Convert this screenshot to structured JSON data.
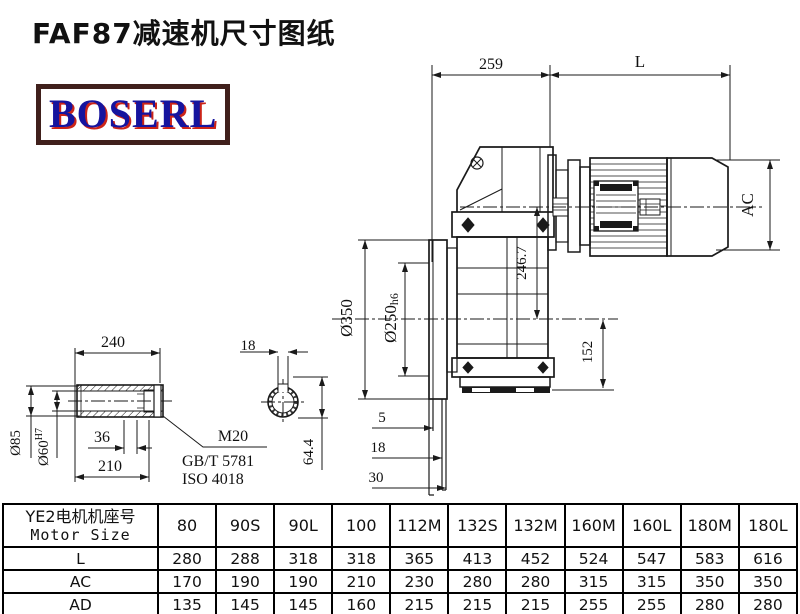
{
  "header": {
    "title": "FAF87减速机尺寸图纸",
    "logo_text": "BOSERL"
  },
  "colors": {
    "line": "#1a1a1a",
    "logo_border": "#40201c",
    "logo_text": "#16149e",
    "logo_shadow": "#cc2418",
    "table_border": "#000000"
  },
  "drawing": {
    "top_dims": {
      "housing_length": "259",
      "motor_length": "L"
    },
    "main_dims": {
      "motor_diameter": "AC",
      "center_distance": "246.7",
      "base_height": "152",
      "flange_od": "Ø350",
      "spigot": "Ø250",
      "spigot_fit": "h6",
      "flange_step1": "5",
      "flange_step2": "18",
      "flange_step3": "30"
    },
    "shaft_dims": {
      "hub_length": "240",
      "bolt_depth": "36",
      "shaft_length": "210",
      "hub_od": "Ø85",
      "bore": "Ø60",
      "bore_fit": "H7",
      "bolt": "M20",
      "bolt_std1": "GB/T 5781",
      "bolt_std2": "ISO 4018"
    },
    "section_dims": {
      "key_width": "18",
      "key_depth": "64.4"
    }
  },
  "table": {
    "header_cn": "YE2电机机座号",
    "header_en": "Motor Size",
    "columns": [
      "80",
      "90S",
      "90L",
      "100",
      "112M",
      "132S",
      "132M",
      "160M",
      "160L",
      "180M",
      "180L"
    ],
    "rows": [
      {
        "label": "L",
        "values": [
          "280",
          "288",
          "318",
          "318",
          "365",
          "413",
          "452",
          "524",
          "547",
          "583",
          "616"
        ]
      },
      {
        "label": "AC",
        "values": [
          "170",
          "190",
          "190",
          "210",
          "230",
          "280",
          "280",
          "315",
          "315",
          "350",
          "350"
        ]
      },
      {
        "label": "AD",
        "values": [
          "135",
          "145",
          "145",
          "160",
          "215",
          "215",
          "215",
          "255",
          "255",
          "280",
          "280"
        ]
      }
    ]
  }
}
